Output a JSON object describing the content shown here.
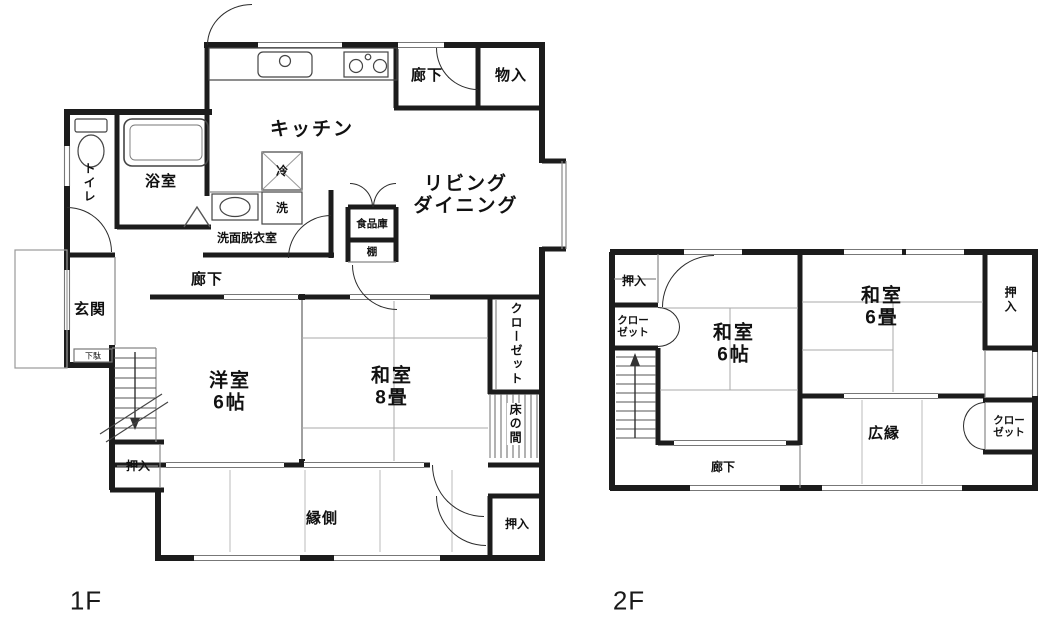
{
  "colors": {
    "wall": "#1c1c1c",
    "thin_line": "#888888",
    "text": "#111111",
    "background": "#ffffff"
  },
  "floors": {
    "f1": {
      "floor_label": "1F",
      "kitchen": "キッチン",
      "hall_top": "廊下",
      "storage_top": "物入",
      "living_dining": "リビング\nダイニング",
      "toilet": "トイレ",
      "bath": "浴室",
      "fridge": "冷",
      "washer": "洗",
      "washroom": "洗面脱衣室",
      "pantry": "食品庫",
      "shelf": "棚",
      "entrance": "玄関",
      "shoe_box": "下駄",
      "hall_mid": "廊下",
      "western_room": "洋室\n6帖",
      "japanese_room": "和室\n8畳",
      "closet": "クローゼット",
      "tokonoma": "床の間",
      "oshiire_bottom_left": "押入",
      "engawa": "縁側",
      "oshiire_bottom_right": "押入"
    },
    "f2": {
      "floor_label": "2F",
      "oshiire_top_left": "押入",
      "closet_left": "クロー\nゼット",
      "japanese_room_6jo": "和室\n6帖",
      "japanese_room_6tatami": "和室\n6畳",
      "oshiire_right": "押入",
      "closet_right": "クロー\nゼット",
      "hiroen": "広縁",
      "hall": "廊下"
    }
  }
}
